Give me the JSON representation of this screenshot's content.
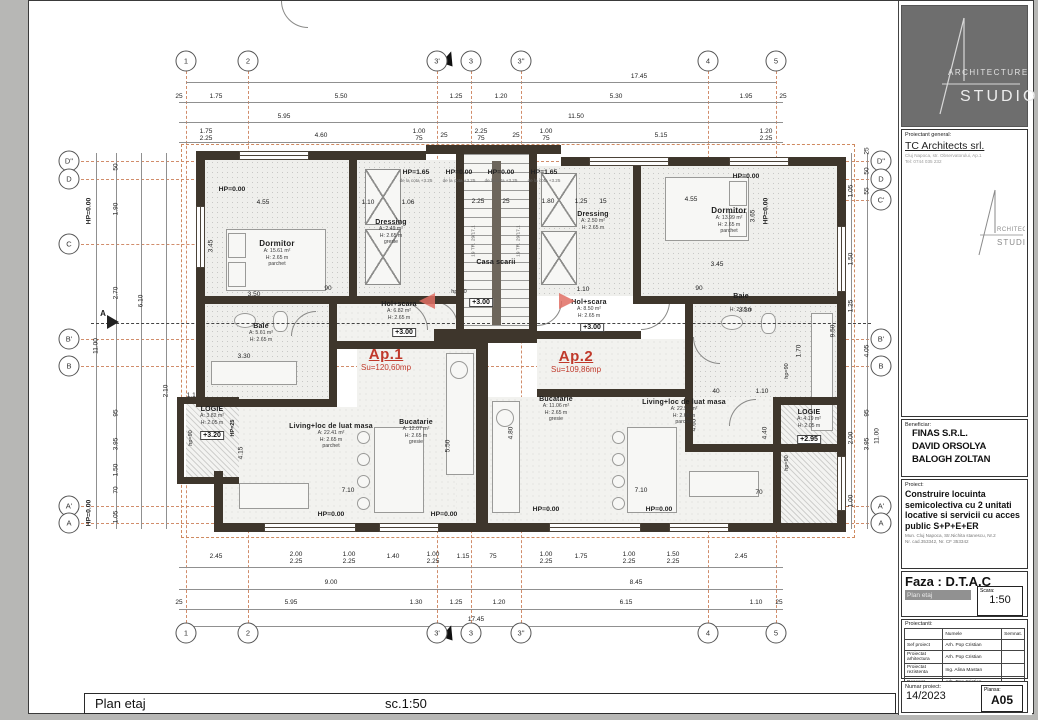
{
  "footer": {
    "title": "Plan etaj",
    "scale": "sc.1:50"
  },
  "grid": {
    "top": [
      "1",
      "2",
      "3'",
      "3",
      "3''",
      "4",
      "5"
    ],
    "left": [
      "D''",
      "D",
      "C",
      "B'",
      "B",
      "A'",
      "A"
    ],
    "right": [
      "D''",
      "D",
      "C'",
      "B'",
      "B",
      "A'",
      "A"
    ],
    "section_marker": "A"
  },
  "dims": {
    "top1": [
      "17.45"
    ],
    "top2": [
      "25",
      "1.75",
      "5.50",
      "1.25",
      "1.20",
      "5.30",
      "1.95",
      "25"
    ],
    "top3": [
      "5.95",
      "11.50"
    ],
    "top4": [
      {
        "a": "1.75",
        "b": "2.25"
      },
      {
        "a": "4.60"
      },
      {
        "a": "1.00",
        "b": "75"
      },
      {
        "a": "25"
      },
      {
        "a": "2.25",
        "b": "75"
      },
      {
        "a": "25"
      },
      {
        "a": "1.00",
        "b": "75"
      },
      {
        "a": "5.15"
      },
      {
        "a": "1.20",
        "b": "2.25"
      }
    ],
    "bot1": [
      {
        "a": "2.45"
      },
      {
        "a": "2.00",
        "b": "2.25"
      },
      {
        "a": "1.00",
        "b": "2.25"
      },
      {
        "a": "1.40"
      },
      {
        "a": "1.00",
        "b": "2.25"
      },
      {
        "a": "1.15"
      },
      {
        "a": "75"
      },
      {
        "a": "1.00",
        "b": "2.25"
      },
      {
        "a": "1.75"
      },
      {
        "a": "1.00",
        "b": "2.25"
      },
      {
        "a": "1.50",
        "b": "2.25"
      },
      {
        "a": "2.45"
      }
    ],
    "bot2": [
      "9.00",
      "8.45"
    ],
    "bot3": [
      "25",
      "5.95",
      "1.30",
      "1.25",
      "1.20",
      "6.15",
      "1.10",
      "25"
    ],
    "bot4": [
      "17.45"
    ],
    "left": [
      "50",
      "1.90",
      "2.70",
      "95",
      "3.95",
      "1.50",
      "70",
      "1.05",
      "6.10",
      "2.10",
      "11.00"
    ],
    "right": [
      "25",
      "50",
      "55",
      "1.05",
      "1.50",
      "1.25",
      "4.05",
      "95",
      "3.95",
      "2.00",
      "1.00",
      "9.50",
      "11.00"
    ],
    "inner": [
      "4.55",
      "1.10",
      "1.06",
      "2.25",
      "25",
      "1.80",
      "1.25",
      "15",
      "4.55",
      "3.45",
      "3.50",
      "90",
      "2.10",
      "1.10",
      "90",
      "2.10",
      "3.45",
      "3.30",
      "1.70",
      "3.30",
      "7.10",
      "7.10",
      "4.15",
      "4.65",
      "4.40",
      "4.80",
      "5.50",
      "40",
      "1.10",
      "70",
      "1.10",
      "3.65"
    ]
  },
  "labels": {
    "hp000": "HP=0.00",
    "hp165": "HP=1.65",
    "cota": "de la cota +3.25",
    "hp90": "hp=90",
    "hp25": "HP=25",
    "stair_note": "19 TR. 29/17,1"
  },
  "levels": {
    "stair": "+3.00",
    "hol1": "+3.00",
    "hol2": "+3.00",
    "log1": "+3.20",
    "log2": "+2.95"
  },
  "apartments": {
    "ap1": {
      "label": "Ap.1",
      "su": "Su=120,60mp"
    },
    "ap2": {
      "label": "Ap.2",
      "su": "Su=109,86mp"
    }
  },
  "rooms": {
    "dorm1": {
      "n": "Dormitor",
      "a": "A: 15.61 m²",
      "h": "H: 2.65 m",
      "f": "parchet"
    },
    "dress1": {
      "n": "Dressing",
      "a": "A: 2.49 m²",
      "h": "H: 2.65 m",
      "f": "gresie"
    },
    "baie1": {
      "n": "Baie",
      "a": "A: 5.61 m²",
      "h": "H: 2.65 m",
      "f": "gresie"
    },
    "hol1": {
      "n": "Hol+scara",
      "a": "A: 6.82 m²",
      "h": "H: 2.65 m",
      "f": "parchet"
    },
    "scara": {
      "n": "Casa scarii"
    },
    "dress2": {
      "n": "Dressing",
      "a": "A: 2.50 m²",
      "h": "H: 2.65 m",
      "f": "gresie"
    },
    "dorm2": {
      "n": "Dormitor",
      "a": "A: 13.99 m²",
      "h": "H: 2.65 m",
      "f": "parchet"
    },
    "baie2": {
      "n": "Baie",
      "a": "A: 5.01 m²",
      "h": "H: 2.65 m",
      "f": "gresie"
    },
    "hol2": {
      "n": "Hol+scara",
      "a": "A: 8.50 m²",
      "h": "H: 2.65 m",
      "f": "parchet"
    },
    "buc1": {
      "n": "Bucatarie",
      "a": "A: 12.07 m²",
      "h": "H: 2.65 m",
      "f": "gresie"
    },
    "buc2": {
      "n": "Bucatarie",
      "a": "A: 11.06 m²",
      "h": "H: 2.65 m",
      "f": "gresie"
    },
    "liv1": {
      "n": "Living+loc de luat masa",
      "a": "A: 22.41 m²",
      "h": "H: 2.65 m",
      "f": "parchet"
    },
    "liv2": {
      "n": "Living+loc de luat masa",
      "a": "A: 22.59 m²",
      "h": "H: 2.65 m",
      "f": "parchet"
    },
    "log1": {
      "n": "LOGIE",
      "a": "A: 3.82 m²",
      "h": "H: 2.05 m"
    },
    "log2": {
      "n": "LOGIE",
      "a": "A: 4.19 m²",
      "h": "H: 2.05 m"
    }
  },
  "titleblock": {
    "logo": {
      "word1": "ARCHITECTURE",
      "word2": "STUDIO"
    },
    "proiectant": {
      "label": "Proiectant general:",
      "name": "TC Architects srl.",
      "addr1": "Cluj Napoca, str. Observatorului, Ap.1",
      "addr2": "Tel: 0744 035 232"
    },
    "beneficiar": {
      "label": "Beneficiar:",
      "lines": [
        "FINAS S.R.L.",
        "DAVID ORSOLYA",
        "BALOGH ZOLTAN"
      ]
    },
    "proiect": {
      "label": "Proiect:",
      "title": "Construire locuinta semicolectiva cu 2 unitati locative si servicii cu acces public  S+P+E+ER",
      "addr1": "Mun. Cluj Napoca, Str.Nichita stanescu, Nr.2",
      "addr2": "Nr. cad.353342,  Nr. CF 353342"
    },
    "faza": {
      "label": "Faza : D.T.A.C",
      "sheet": "Plan etaj",
      "scara_label": "Scara:",
      "scara": "1:50"
    },
    "proiectanti": {
      "label": "Proiectanti:",
      "col_name": "Numele",
      "col_sign": "Semnat.",
      "rows": [
        {
          "role": "Sef proiect",
          "name": "Arh. Pop Cristian"
        },
        {
          "role": "Proiectat arhitectura",
          "name": "Arh. Pop Cristian"
        },
        {
          "role": "Proiectat rezistenta",
          "name": "Ing. Alina Mastan"
        },
        {
          "role": "Desenat",
          "name": "Arh. Pop Cristian"
        }
      ]
    },
    "numar": {
      "label": "Numar proiect:",
      "value": "14/2023",
      "plansa_label": "Plansa:",
      "plansa": "A05"
    }
  }
}
